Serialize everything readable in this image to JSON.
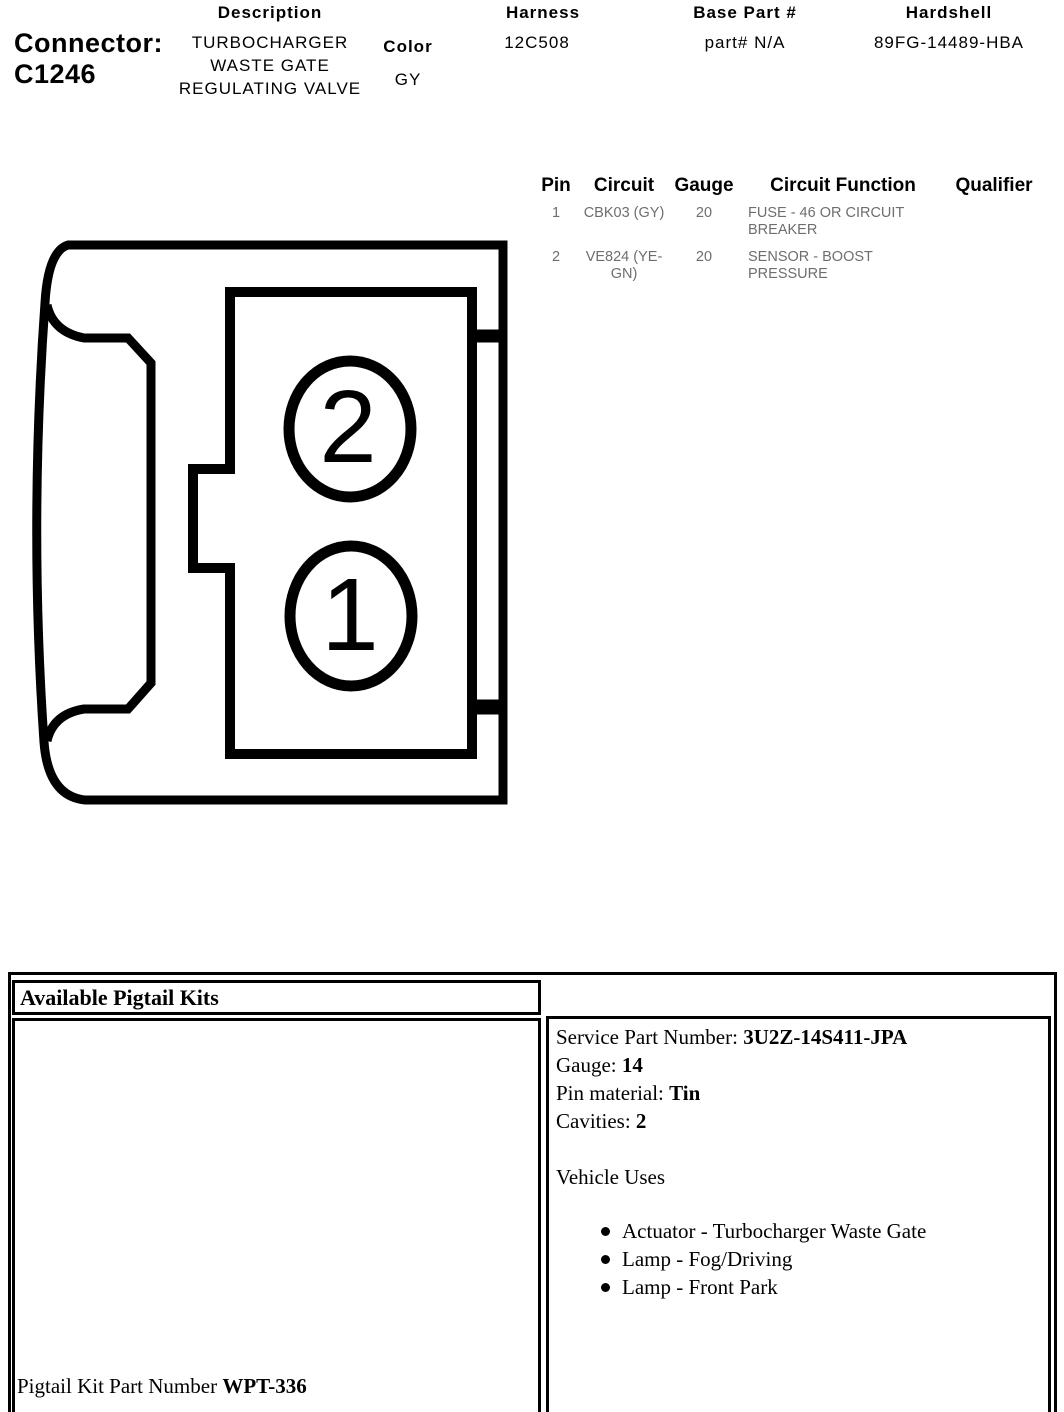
{
  "header": {
    "connector_label": "Connector:",
    "connector_id": "C1246",
    "description": {
      "label": "Description",
      "value": "TURBOCHARGER WASTE GATE REGULATING VALVE"
    },
    "color": {
      "label": "Color",
      "value": "GY"
    },
    "harness": {
      "label": "Harness",
      "value": "12C508"
    },
    "base_part": {
      "label": "Base Part #",
      "value": "part# N/A"
    },
    "hardshell": {
      "label": "Hardshell",
      "value": "89FG-14489-HBA"
    }
  },
  "pin_table": {
    "headers": {
      "pin": "Pin",
      "circuit": "Circuit",
      "gauge": "Gauge",
      "function": "Circuit Function",
      "qualifier": "Qualifier"
    },
    "rows": [
      {
        "pin": "1",
        "circuit": "CBK03 (GY)",
        "gauge": "20",
        "function": "FUSE - 46 OR CIRCUIT BREAKER",
        "qualifier": ""
      },
      {
        "pin": "2",
        "circuit": "VE824 (YE-GN)",
        "gauge": "20",
        "function": "SENSOR - BOOST PRESSURE",
        "qualifier": ""
      }
    ]
  },
  "diagram": {
    "pin_2_label": "2",
    "pin_1_label": "1"
  },
  "pigtail_kits": {
    "title": "Available Pigtail Kits",
    "part_number_label": "Pigtail Kit Part Number",
    "part_number_value": "WPT-336"
  },
  "service_info": {
    "service_part": {
      "label": "Service Part Number:",
      "value": "3U2Z-14S411-JPA"
    },
    "gauge": {
      "label": "Gauge:",
      "value": "14"
    },
    "pin_material": {
      "label": "Pin material:",
      "value": "Tin"
    },
    "cavities": {
      "label": "Cavities:",
      "value": "2"
    },
    "vehicle_uses_title": "Vehicle Uses",
    "vehicle_uses": [
      "Actuator - Turbocharger Waste Gate",
      "Lamp - Fog/Driving",
      "Lamp - Front Park"
    ]
  },
  "colors": {
    "ink": "#000000",
    "table_text": "#6e6e6e",
    "background": "#ffffff"
  }
}
